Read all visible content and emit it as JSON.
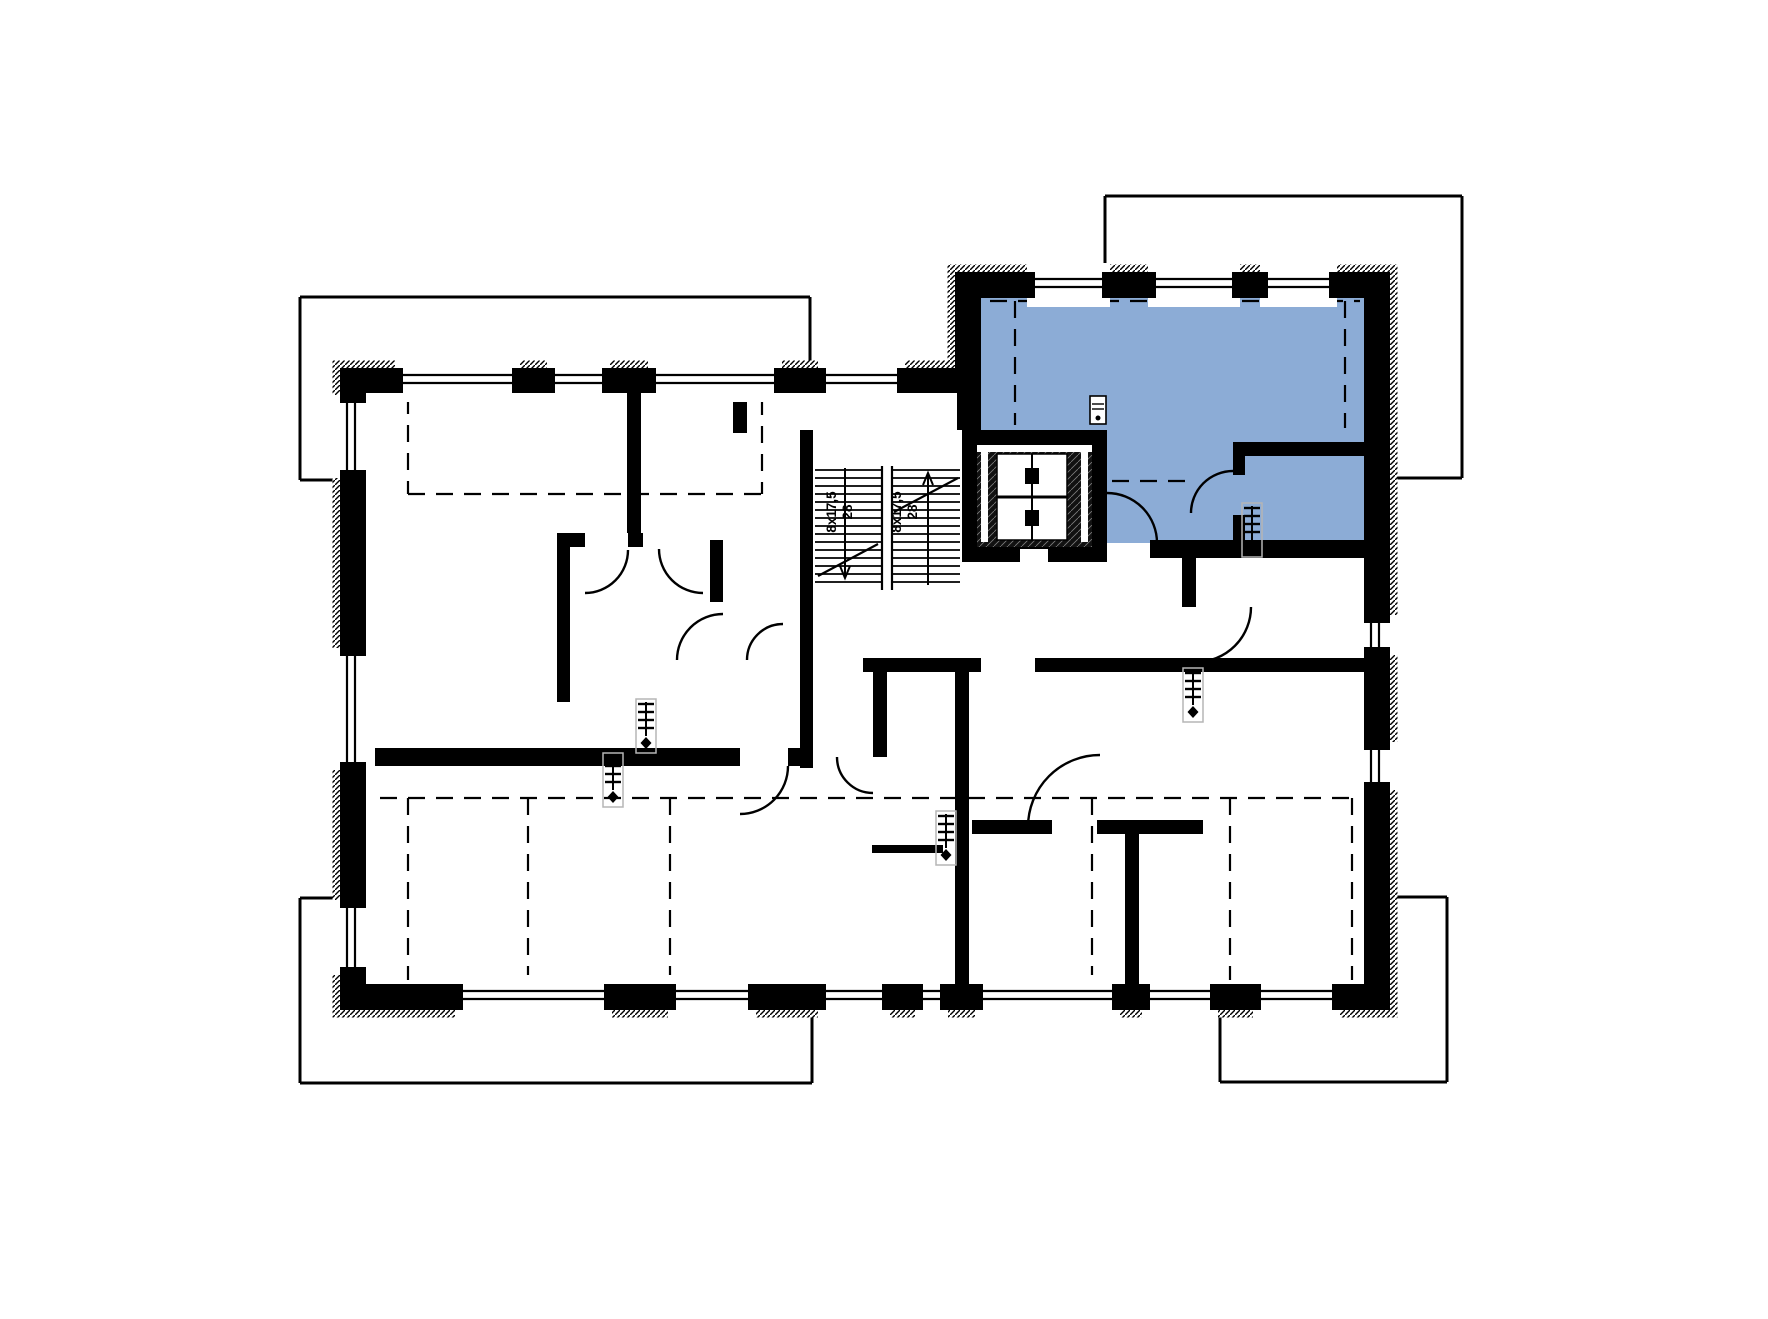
{
  "plan": {
    "type": "floor-plan",
    "canvas": {
      "width": 1768,
      "height": 1319
    },
    "colors": {
      "background": "#ffffff",
      "lines": "#000000",
      "highlight_unit": "#8cacd6",
      "radiator_box": "#b5b5b5",
      "lift_interior": "#111111"
    },
    "highlight_unit": {
      "points": [
        [
          981,
          298
        ],
        [
          1364,
          298
        ],
        [
          1364,
          543
        ],
        [
          1107,
          543
        ],
        [
          1107,
          430
        ],
        [
          981,
          430
        ]
      ]
    },
    "roof_outline_segments": [
      [
        300,
        297,
        810,
        297
      ],
      [
        300,
        297,
        300,
        480
      ],
      [
        300,
        480,
        342,
        480
      ],
      [
        810,
        297,
        810,
        369
      ],
      [
        1105,
        196,
        1462,
        196
      ],
      [
        1105,
        196,
        1105,
        273
      ],
      [
        1462,
        196,
        1462,
        478
      ],
      [
        1389,
        478,
        1462,
        478
      ],
      [
        300,
        898,
        300,
        1083
      ],
      [
        300,
        898,
        342,
        898
      ],
      [
        300,
        1083,
        812,
        1083
      ],
      [
        812,
        1009,
        812,
        1083
      ],
      [
        1389,
        897,
        1447,
        897
      ],
      [
        1447,
        897,
        1447,
        1082
      ],
      [
        1220,
        1082,
        1447,
        1082
      ],
      [
        1220,
        1009,
        1220,
        1082
      ]
    ],
    "envelope": {
      "outer": [
        [
          340,
          368
        ],
        [
          955,
          368
        ],
        [
          955,
          272
        ],
        [
          1390,
          272
        ],
        [
          1390,
          1010
        ],
        [
          340,
          1010
        ]
      ],
      "inner": [
        [
          366,
          393
        ],
        [
          981,
          393
        ],
        [
          981,
          298
        ],
        [
          1364,
          298
        ],
        [
          1364,
          984
        ],
        [
          366,
          984
        ]
      ]
    },
    "interior_walls": [
      [
        627,
        393,
        14,
        140
      ],
      [
        557,
        533,
        28,
        14
      ],
      [
        628,
        533,
        15,
        14
      ],
      [
        710,
        540,
        13,
        62
      ],
      [
        800,
        430,
        13,
        338
      ],
      [
        733,
        393,
        14,
        40
      ],
      [
        557,
        547,
        13,
        155
      ],
      [
        366,
        748,
        374,
        18
      ],
      [
        788,
        748,
        25,
        18
      ],
      [
        957,
        393,
        24,
        37
      ],
      [
        863,
        658,
        118,
        14
      ],
      [
        1035,
        658,
        329,
        14
      ],
      [
        955,
        672,
        14,
        312
      ],
      [
        873,
        672,
        14,
        85
      ],
      [
        872,
        845,
        71,
        8
      ],
      [
        972,
        820,
        80,
        14
      ],
      [
        1097,
        820,
        106,
        14
      ],
      [
        1125,
        834,
        14,
        150
      ],
      [
        1233,
        442,
        131,
        14
      ],
      [
        1233,
        456,
        12,
        19
      ],
      [
        1233,
        515,
        12,
        28
      ],
      [
        1150,
        540,
        214,
        18
      ],
      [
        1182,
        558,
        14,
        49
      ]
    ],
    "window_bands": [
      {
        "orient": "h",
        "pos": 368,
        "t": 25,
        "items": [
          [
            395,
            520
          ],
          [
            547,
            610
          ],
          [
            648,
            782
          ],
          [
            818,
            905
          ]
        ]
      },
      {
        "orient": "h",
        "pos": 272,
        "t": 26,
        "items": [
          [
            1027,
            1110
          ],
          [
            1148,
            1240
          ],
          [
            1260,
            1337
          ]
        ]
      },
      {
        "orient": "h",
        "pos": 984,
        "t": 26,
        "items": [
          [
            455,
            612
          ],
          [
            668,
            756
          ],
          [
            818,
            890
          ],
          [
            915,
            948
          ],
          [
            975,
            1120
          ],
          [
            1142,
            1218
          ],
          [
            1253,
            1340
          ]
        ]
      },
      {
        "orient": "v",
        "pos": 340,
        "t": 26,
        "items": [
          [
            395,
            478
          ],
          [
            648,
            770
          ],
          [
            900,
            975
          ]
        ]
      },
      {
        "orient": "v",
        "pos": 1364,
        "t": 26,
        "items": [
          [
            615,
            655
          ],
          [
            742,
            790
          ]
        ]
      }
    ],
    "dashed_slope_lines": [
      [
        408,
        397,
        408,
        494
      ],
      [
        408,
        494,
        762,
        494
      ],
      [
        762,
        398,
        762,
        494
      ],
      [
        990,
        301,
        1360,
        301
      ],
      [
        1015,
        301,
        1015,
        425
      ],
      [
        1345,
        301,
        1345,
        428
      ],
      [
        1112,
        481,
        1190,
        481
      ],
      [
        380,
        798,
        1355,
        798
      ],
      [
        408,
        798,
        408,
        980
      ],
      [
        528,
        798,
        528,
        980
      ],
      [
        670,
        798,
        670,
        980
      ],
      [
        1092,
        798,
        1092,
        980
      ],
      [
        1230,
        798,
        1230,
        980
      ],
      [
        1352,
        798,
        1352,
        980
      ]
    ],
    "stairs": {
      "tread_top": 470,
      "tread_bottom": 582,
      "tread_step": 8,
      "rail_x": [
        882,
        892
      ],
      "rail_y": [
        466,
        590
      ],
      "diagonals": [
        [
          818,
          576,
          878,
          544
        ],
        [
          894,
          512,
          958,
          478
        ]
      ],
      "label_y": 512,
      "flights": [
        {
          "name": "flight-down",
          "x1": 815,
          "x2": 882,
          "dir_x": 845,
          "arrow": "down",
          "riser_label": "8x17,5",
          "tread_label": "28",
          "riser_label_x": 836,
          "tread_label_x": 852
        },
        {
          "name": "flight-up",
          "x1": 892,
          "x2": 960,
          "dir_x": 928,
          "arrow": "up",
          "riser_label": "8x17,5",
          "tread_label": "28",
          "riser_label_x": 901,
          "tread_label_x": 917
        }
      ]
    },
    "elevator": {
      "shaft": [
        962,
        430,
        145,
        132
      ],
      "interior": [
        977,
        445,
        115,
        102
      ],
      "top_slit": [
        977,
        445,
        115,
        7
      ],
      "side_slits": [
        [
          981,
          452,
          7,
          90
        ],
        [
          1081,
          452,
          7,
          90
        ]
      ],
      "car": [
        997,
        454,
        70,
        86
      ],
      "car_center_line_y": 497,
      "car_blocks": [
        [
          1025,
          468,
          14,
          16
        ],
        [
          1025,
          510,
          14,
          16
        ]
      ],
      "car_axis_x": 1032,
      "door_slit": [
        1020,
        549,
        28,
        14
      ]
    },
    "doors": [
      {
        "x1": 659,
        "y1": 549,
        "x2": 703,
        "y2": 593,
        "r": 44,
        "sweep": 0
      },
      {
        "x1": 723,
        "y1": 614,
        "x2": 677,
        "y2": 660,
        "r": 46,
        "sweep": 0
      },
      {
        "x1": 783,
        "y1": 624,
        "x2": 747,
        "y2": 660,
        "r": 36,
        "sweep": 0
      },
      {
        "x1": 1251,
        "y1": 607,
        "x2": 1196,
        "y2": 662,
        "r": 55,
        "sweep": 1
      },
      {
        "x1": 1157,
        "y1": 543,
        "x2": 1107,
        "y2": 493,
        "r": 50,
        "sweep": 0
      },
      {
        "x1": 1191,
        "y1": 513,
        "x2": 1233,
        "y2": 471,
        "r": 42,
        "sweep": 1
      },
      {
        "x1": 788,
        "y1": 766,
        "x2": 740,
        "y2": 814,
        "r": 48,
        "sweep": 1
      },
      {
        "x1": 837,
        "y1": 757,
        "x2": 873,
        "y2": 793,
        "r": 36,
        "sweep": 0
      },
      {
        "x1": 628,
        "y1": 550,
        "x2": 585,
        "y2": 593,
        "r": 43,
        "sweep": 1
      },
      {
        "x1": 1028,
        "y1": 827,
        "x2": 1100,
        "y2": 755,
        "r": 72,
        "sweep": 1
      }
    ],
    "radiators": [
      [
        646,
        726
      ],
      [
        613,
        780
      ],
      [
        1193,
        695
      ],
      [
        1252,
        530
      ],
      [
        946,
        838
      ]
    ],
    "electrical_panel": {
      "x": 1090,
      "y": 396,
      "w": 16,
      "h": 28
    }
  }
}
